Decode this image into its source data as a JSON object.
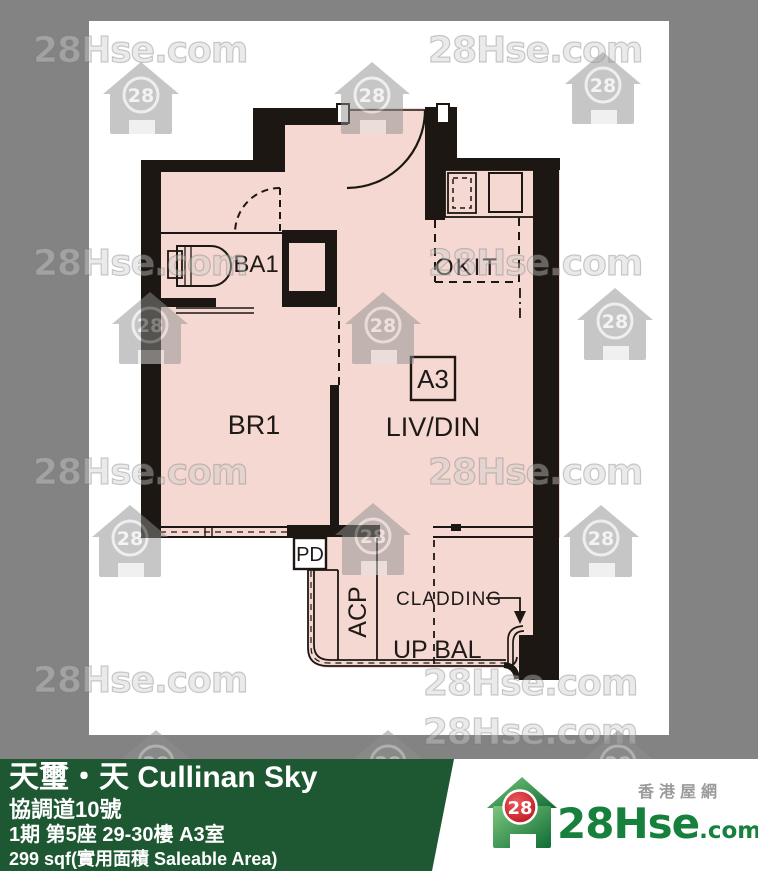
{
  "page": {
    "background": "#838383",
    "panel": "#ffffff"
  },
  "watermark": {
    "text": "28Hse.com",
    "icon_number": "28"
  },
  "floorplan": {
    "unit_label": "A3",
    "labels": {
      "bathroom": "BA1",
      "bedroom": "BR1",
      "living_dining": "LIV/DIN",
      "open_kitchen": "OKIT",
      "pipe_duct": "PD",
      "acp": "ACP",
      "cladding": "CLADDING",
      "balcony": "UP BAL"
    },
    "colors": {
      "floor": "#f5d8d1",
      "wall": "#1c1712"
    }
  },
  "footer": {
    "background": "#1e5833",
    "title": "天璽・天 Cullinan Sky",
    "address": "協調道10號",
    "unit": "1期 第5座 29-30樓 A3室",
    "area": "299 sqf(實用面積 Saleable Area)"
  },
  "logo": {
    "number": "28",
    "name": "28Hse",
    "domain": ".com",
    "tagline": "香港屋網",
    "circle_color": "#c8161d",
    "green": "#17803d"
  }
}
